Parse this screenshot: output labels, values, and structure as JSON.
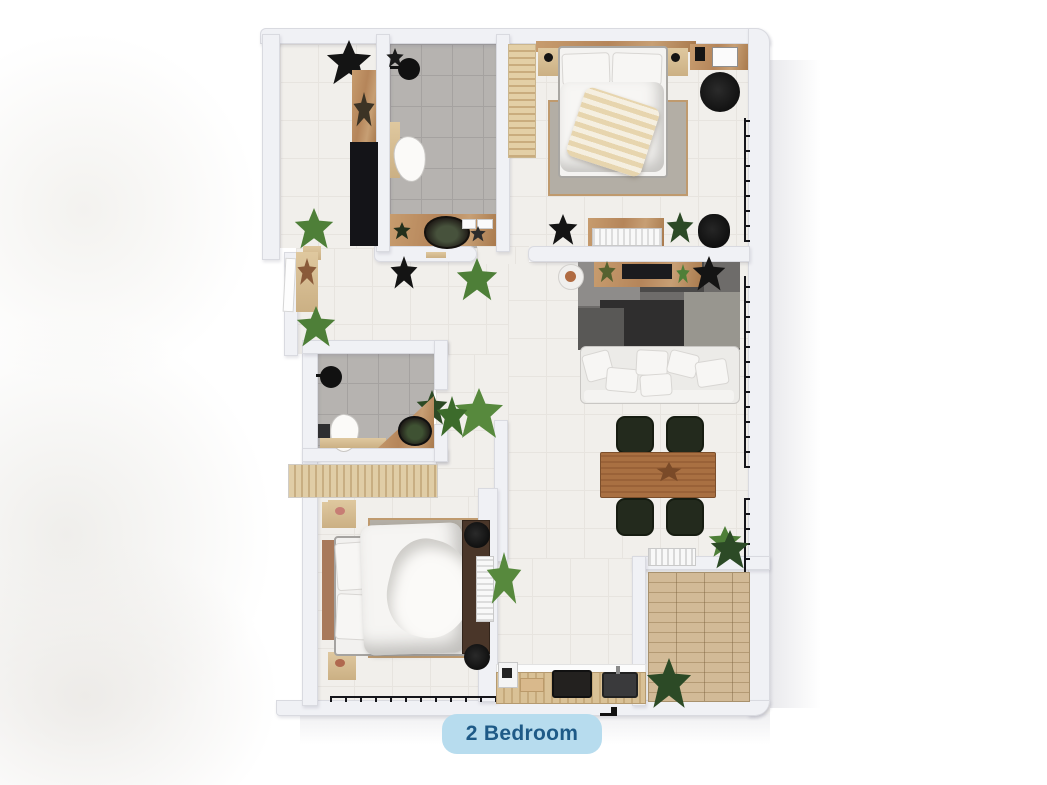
{
  "floor_plan": {
    "badge_label": "2 Bedroom",
    "rooms": [
      {
        "name": "entry-hall",
        "items": [
          "black-wardrobe",
          "shelf",
          "plants",
          "door-leaf"
        ]
      },
      {
        "name": "bathroom-1",
        "items": [
          "shower-head",
          "toilet",
          "wood-vanity",
          "stone-basin"
        ]
      },
      {
        "name": "bedroom-1",
        "items": [
          "double-bed",
          "pillows",
          "striped-throw",
          "area-rug",
          "nightstands",
          "slatted-wardrobe",
          "desk",
          "office-chair",
          "console-with-radiator"
        ]
      },
      {
        "name": "living-dining",
        "items": [
          "tv-console",
          "tv",
          "dark-patterned-rug",
          "sofa",
          "cushions",
          "side-table",
          "dining-table",
          "four-chairs",
          "plants"
        ]
      },
      {
        "name": "bathroom-2",
        "items": [
          "shower-head",
          "toilet",
          "corner-wood-vanity",
          "stone-basin"
        ]
      },
      {
        "name": "hallway-closet",
        "items": [
          "slatted-closet",
          "wood-stool",
          "plants"
        ]
      },
      {
        "name": "bedroom-2",
        "items": [
          "double-bed",
          "rumpled-duvet",
          "area-rug",
          "nightstands",
          "dresser",
          "radiator",
          "poufs"
        ]
      },
      {
        "name": "kitchen",
        "items": [
          "counter",
          "cooktop",
          "sink",
          "coffee-machine",
          "cutting-board"
        ]
      },
      {
        "name": "balcony",
        "items": [
          "wood-plank-deck",
          "plants",
          "ac-unit"
        ]
      }
    ],
    "colors": {
      "badge_bg": "#b7dcee",
      "badge_text": "#1e5a87",
      "wall": "#f0f1f5",
      "floor_tile": "#f1efeb",
      "bathroom_tile": "#b6b3b0",
      "wood_light": "#dfc89f",
      "wood_mid": "#b5855a",
      "wood_dark": "#4a3629",
      "deck": "#c9b191",
      "plant_green": "#4e7f38",
      "plant_dark": "#161616",
      "rug_dark": "#4a4a4a",
      "rug_beige": "#b3aea5"
    }
  }
}
